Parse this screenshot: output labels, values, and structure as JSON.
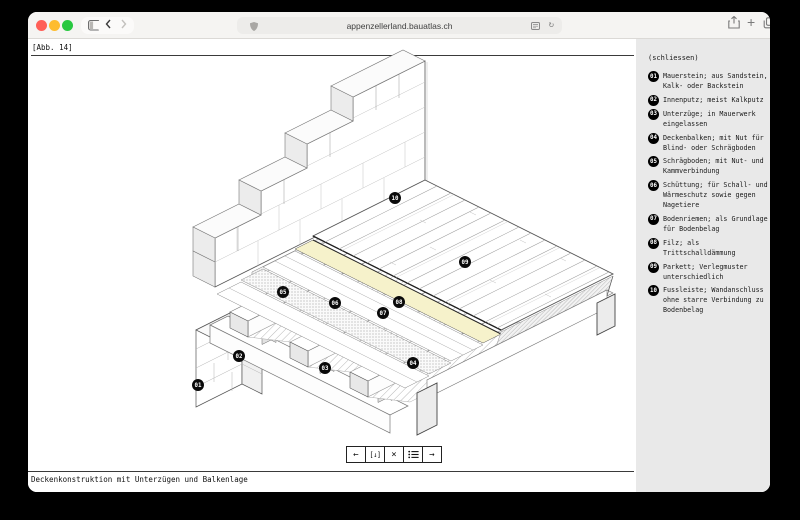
{
  "browser": {
    "url": "appenzellerland.bauatlas.ch",
    "icons": [
      "sidebar-toggle-icon",
      "chevron-down-icon",
      "back-icon",
      "forward-icon",
      "shield-icon",
      "reader-icon",
      "reload-icon",
      "share-icon",
      "new-tab-icon",
      "tabs-icon"
    ],
    "traffic_colors": {
      "close": "#ff5f57",
      "minimize": "#febc2e",
      "zoom": "#28c840"
    }
  },
  "figure": {
    "label": "[Abb. 14]",
    "caption": "Deckenkonstruktion mit Unterzügen und Balkenlage"
  },
  "sidebar": {
    "close_label": "(schliessen)",
    "background": "#e9e9e9",
    "items": [
      {
        "num": "01",
        "text": "Mauerstein; aus Sandstein, Kalk- oder Backstein"
      },
      {
        "num": "02",
        "text": "Innenputz; meist Kalkputz"
      },
      {
        "num": "03",
        "text": "Unterzüge; in Mauerwerk eingelassen"
      },
      {
        "num": "04",
        "text": "Deckenbalken; mit Nut für Blind- oder Schrägboden"
      },
      {
        "num": "05",
        "text": "Schrägboden; mit Nut- und Kammverbindung"
      },
      {
        "num": "06",
        "text": "Schüttung; für Schall- und Wärmeschutz sowie gegen Nagetiere"
      },
      {
        "num": "07",
        "text": "Bodenriemen; als Grundlage für Bodenbelag"
      },
      {
        "num": "08",
        "text": "Filz; als Trittschalldämmung"
      },
      {
        "num": "09",
        "text": "Parkett; Verlegmuster unterschiedlich"
      },
      {
        "num": "10",
        "text": "Fussleiste; Wandanschluss ohne starre Verbindung zu Bodenbelag"
      }
    ]
  },
  "toolbar": {
    "buttons": [
      {
        "name": "prev-figure",
        "label": "←"
      },
      {
        "name": "download",
        "label": "[↓]"
      },
      {
        "name": "close-figure",
        "label": "×"
      },
      {
        "name": "index-list",
        "label": "≡"
      },
      {
        "name": "next-figure",
        "label": "→"
      }
    ]
  },
  "diagram": {
    "felt_color": "#f6f2cb",
    "labels": [
      "01",
      "02",
      "03",
      "04",
      "05",
      "06",
      "07",
      "08",
      "09",
      "10"
    ]
  }
}
